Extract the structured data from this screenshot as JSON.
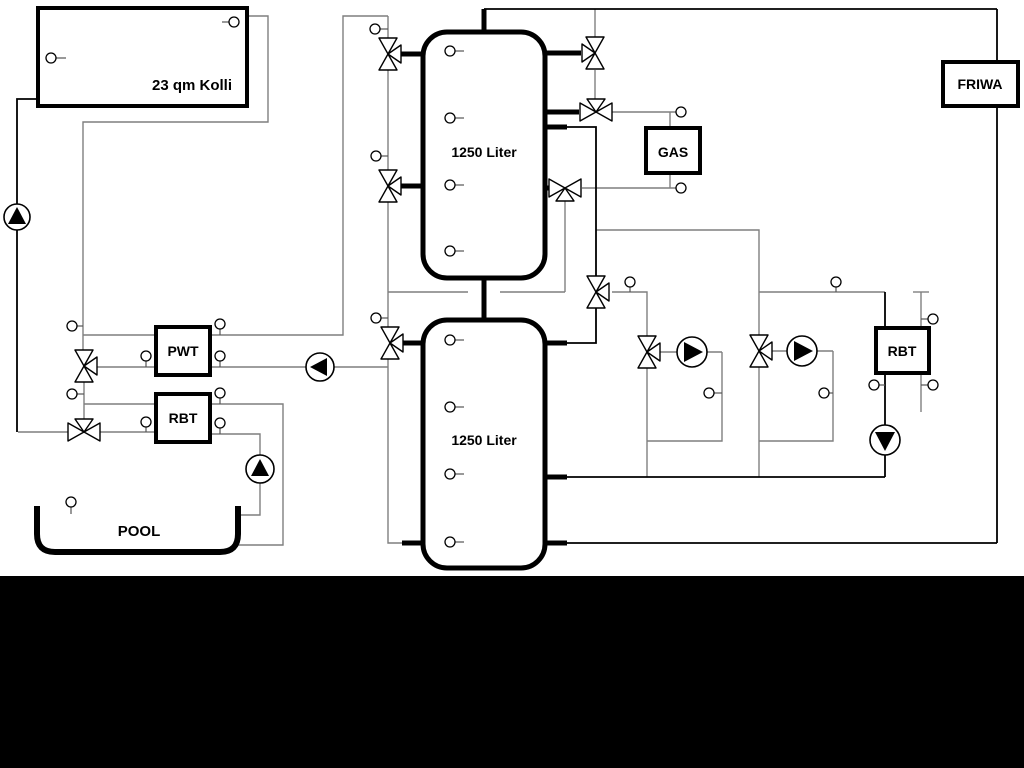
{
  "diagram": {
    "collector": {
      "label": "23 qm Kolli"
    },
    "tank_top": {
      "label": "1250 Liter"
    },
    "tank_bottom": {
      "label": "1250 Liter"
    },
    "gas": {
      "label": "GAS"
    },
    "friwa": {
      "label": "FRIWA"
    },
    "pwt": {
      "label": "PWT"
    },
    "rbt_pool": {
      "label": "RBT"
    },
    "rbt_heating": {
      "label": "RBT"
    },
    "pool": {
      "label": "POOL"
    },
    "colors": {
      "background": "#ffffff",
      "bottom_band": "#000000",
      "pipe_gray": "#7f7f7f",
      "pipe_black": "#000000"
    }
  }
}
